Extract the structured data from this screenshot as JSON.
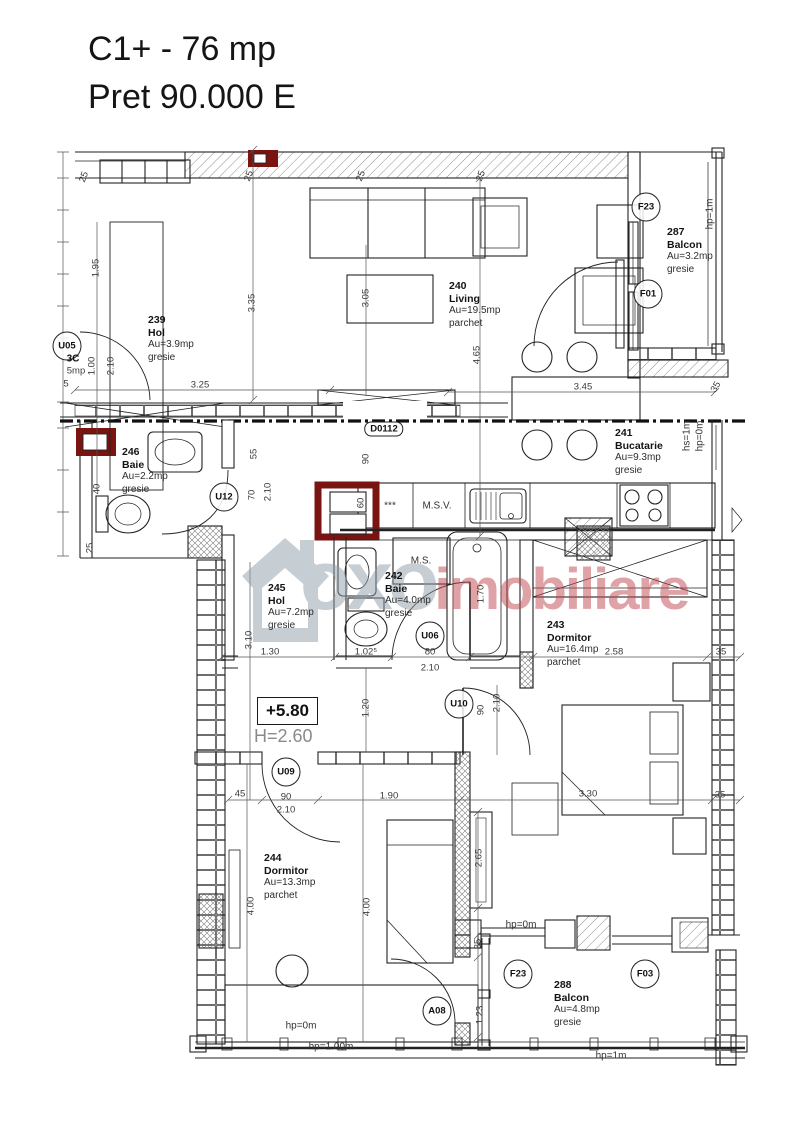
{
  "header": {
    "title": "C1+ - 76 mp",
    "price": "Pret 90.000 E"
  },
  "level": {
    "value": "+5.80",
    "height": "H=2.60"
  },
  "watermark": {
    "brand_gray": "oxo",
    "brand_accent": "imobiliare"
  },
  "colors": {
    "line": "#222222",
    "highlight_red": "#7a1410",
    "watermark_gray": "#8e9da9",
    "watermark_accent": "#c04a52"
  },
  "rooms": [
    {
      "number": "239",
      "name": "Hol",
      "area": "Au=3.9mp",
      "floor": "gresie",
      "x": 148,
      "y": 314
    },
    {
      "number": "240",
      "name": "Living",
      "area": "Au=19.5mp",
      "floor": "parchet",
      "x": 449,
      "y": 280
    },
    {
      "number": "287",
      "name": "Balcon",
      "area": "Au=3.2mp",
      "floor": "gresie",
      "x": 667,
      "y": 226
    },
    {
      "number": "241",
      "name": "Bucatarie",
      "area": "Au=9.3mp",
      "floor": "gresie",
      "x": 615,
      "y": 427
    },
    {
      "number": "246",
      "name": "Baie",
      "area": "Au=2.2mp",
      "floor": "gresie",
      "x": 122,
      "y": 446
    },
    {
      "number": "245",
      "name": "Hol",
      "area": "Au=7.2mp",
      "floor": "gresie",
      "x": 268,
      "y": 582
    },
    {
      "number": "242",
      "name": "Baie",
      "area": "Au=4.0mp",
      "floor": "gresie",
      "x": 385,
      "y": 570
    },
    {
      "number": "243",
      "name": "Dormitor",
      "area": "Au=16.4mp",
      "floor": "parchet",
      "x": 547,
      "y": 619
    },
    {
      "number": "244",
      "name": "Dormitor",
      "area": "Au=13.3mp",
      "floor": "parchet",
      "x": 264,
      "y": 852
    },
    {
      "number": "288",
      "name": "Balcon",
      "area": "Au=4.8mp",
      "floor": "gresie",
      "x": 554,
      "y": 979
    }
  ],
  "tags": [
    {
      "t": "F23",
      "x": 646,
      "y": 207,
      "s": "circle"
    },
    {
      "t": "F01",
      "x": 648,
      "y": 294,
      "s": "circle"
    },
    {
      "t": "U12",
      "x": 224,
      "y": 497,
      "s": "circle"
    },
    {
      "t": "U06",
      "x": 430,
      "y": 636,
      "s": "circle"
    },
    {
      "t": "U10",
      "x": 459,
      "y": 704,
      "s": "circle"
    },
    {
      "t": "U09",
      "x": 286,
      "y": 772,
      "s": "circle"
    },
    {
      "t": "A08",
      "x": 437,
      "y": 1011,
      "s": "circle"
    },
    {
      "t": "F23",
      "x": 518,
      "y": 974,
      "s": "circle"
    },
    {
      "t": "F03",
      "x": 645,
      "y": 974,
      "s": "circle"
    },
    {
      "t": "U05",
      "x": 67,
      "y": 346,
      "s": "circle"
    },
    {
      "t": "D0112",
      "x": 384,
      "y": 429,
      "s": "roundrect"
    }
  ],
  "annotations": [
    {
      "t": "M.S.V.",
      "x": 437,
      "y": 506,
      "r": 0
    },
    {
      "t": "M.S.",
      "x": 421,
      "y": 561,
      "r": 0
    },
    {
      "t": "***",
      "x": 390,
      "y": 506,
      "r": 0
    },
    {
      "t": "hp=1m",
      "x": 710,
      "y": 214,
      "r": -90
    },
    {
      "t": "hs=1m",
      "x": 687,
      "y": 436,
      "r": -90
    },
    {
      "t": "hp=0m",
      "x": 700,
      "y": 436,
      "r": -90
    },
    {
      "t": "hp=0m",
      "x": 521,
      "y": 925,
      "r": 0
    },
    {
      "t": "hp=0m",
      "x": 301,
      "y": 1026,
      "r": 0
    },
    {
      "t": "hp=1.00m",
      "x": 331,
      "y": 1047,
      "r": 0
    },
    {
      "t": "hp=1m",
      "x": 611,
      "y": 1056,
      "r": 0
    }
  ],
  "dimensions": [
    {
      "t": "25",
      "x": 84,
      "y": 177,
      "r": -70
    },
    {
      "t": "1.95",
      "x": 96,
      "y": 268,
      "r": -90
    },
    {
      "t": "25",
      "x": 249,
      "y": 176,
      "r": -70
    },
    {
      "t": "25",
      "x": 361,
      "y": 176,
      "r": -70
    },
    {
      "t": "25",
      "x": 481,
      "y": 176,
      "r": -70
    },
    {
      "t": "3.35",
      "x": 252,
      "y": 303,
      "r": -90
    },
    {
      "t": "3.05",
      "x": 366,
      "y": 298,
      "r": -90
    },
    {
      "t": "4.65",
      "x": 477,
      "y": 355,
      "r": -90
    },
    {
      "t": "1.00",
      "x": 92,
      "y": 366,
      "r": -90
    },
    {
      "t": "2.10",
      "x": 111,
      "y": 366,
      "r": -90
    },
    {
      "t": "3.25",
      "x": 200,
      "y": 385,
      "r": 0
    },
    {
      "t": "3.45",
      "x": 583,
      "y": 387,
      "r": 0
    },
    {
      "t": "35",
      "x": 716,
      "y": 387,
      "r": -60
    },
    {
      "t": "40",
      "x": 97,
      "y": 489,
      "r": -90
    },
    {
      "t": "25",
      "x": 90,
      "y": 548,
      "r": -90
    },
    {
      "t": "90",
      "x": 366,
      "y": 459,
      "r": -90
    },
    {
      "t": "60",
      "x": 361,
      "y": 503,
      "r": -90
    },
    {
      "t": "55",
      "x": 254,
      "y": 454,
      "r": -90
    },
    {
      "t": "70",
      "x": 252,
      "y": 495,
      "r": -90
    },
    {
      "t": "2.10",
      "x": 268,
      "y": 492,
      "r": -90
    },
    {
      "t": "3.10",
      "x": 249,
      "y": 640,
      "r": -90
    },
    {
      "t": "1.30",
      "x": 270,
      "y": 652,
      "r": 0
    },
    {
      "t": "1.02⁵",
      "x": 366,
      "y": 652,
      "r": 0
    },
    {
      "t": "80",
      "x": 430,
      "y": 652,
      "r": 0
    },
    {
      "t": "2.10",
      "x": 430,
      "y": 668,
      "r": 0
    },
    {
      "t": "2.58",
      "x": 614,
      "y": 652,
      "r": 0
    },
    {
      "t": "35",
      "x": 721,
      "y": 652,
      "r": 0
    },
    {
      "t": "1.70",
      "x": 481,
      "y": 594,
      "r": -90
    },
    {
      "t": "1.20",
      "x": 366,
      "y": 708,
      "r": -90
    },
    {
      "t": "90",
      "x": 481,
      "y": 710,
      "r": -90
    },
    {
      "t": "2.10",
      "x": 497,
      "y": 703,
      "r": -90
    },
    {
      "t": "45",
      "x": 240,
      "y": 794,
      "r": 0
    },
    {
      "t": "90",
      "x": 286,
      "y": 797,
      "r": 0
    },
    {
      "t": "2.10",
      "x": 286,
      "y": 810,
      "r": 0
    },
    {
      "t": "1.90",
      "x": 389,
      "y": 796,
      "r": 0
    },
    {
      "t": "3.30",
      "x": 588,
      "y": 794,
      "r": 0
    },
    {
      "t": "35",
      "x": 720,
      "y": 795,
      "r": 0
    },
    {
      "t": "4.00",
      "x": 251,
      "y": 906,
      "r": -90
    },
    {
      "t": "4.00",
      "x": 367,
      "y": 907,
      "r": -90
    },
    {
      "t": "2.65",
      "x": 479,
      "y": 858,
      "r": -90
    },
    {
      "t": "35",
      "x": 478,
      "y": 944,
      "r": -90
    },
    {
      "t": "1.23",
      "x": 480,
      "y": 1015,
      "r": -90
    },
    {
      "t": "5",
      "x": 66,
      "y": 384,
      "r": 0
    },
    {
      "t": "5mp",
      "x": 76,
      "y": 371,
      "r": 0
    },
    {
      "t": "3C",
      "x": 73,
      "y": 359,
      "r": 0,
      "b": 1
    }
  ]
}
